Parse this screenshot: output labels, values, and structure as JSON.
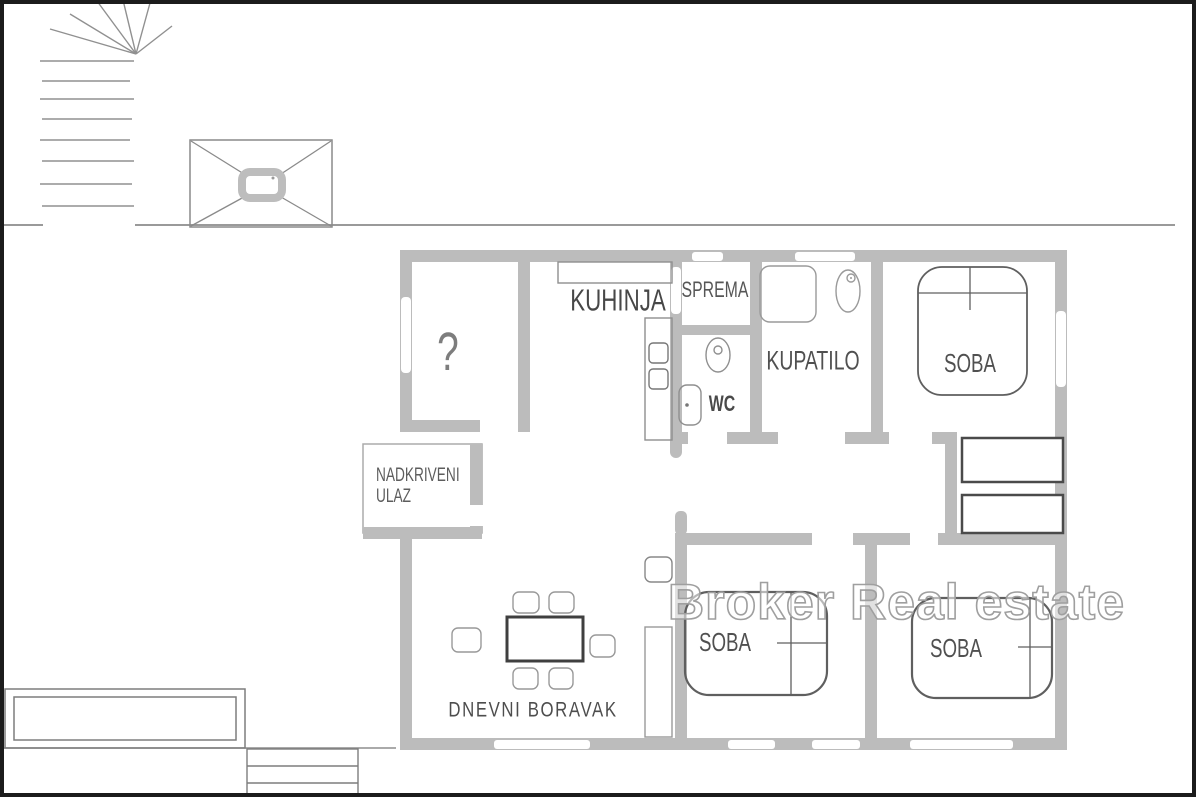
{
  "plan": {
    "labels": {
      "kitchen": "KUHINJA",
      "pantry": "SPREMA",
      "bathroom": "KUPATILO",
      "wc": "WC",
      "bedroom_top": "SOBA",
      "bedroom_middle": "SOBA",
      "bedroom_right": "SOBA",
      "living_room": "DNEVNI BORAVAK",
      "unknown_room": "?",
      "covered_entrance_line1": "NADKRIVENI",
      "covered_entrance_line2": "ULAZ"
    },
    "watermark": "Broker Real estate",
    "colors": {
      "wall": "#bcbcbc",
      "thin_outline": "#8f8f8f",
      "dark_furniture": "#4a4a4a",
      "label_text": "#4d4d4d",
      "watermark_outline": "#9f9f9f",
      "frame": "#1c1c1c",
      "background": "#ffffff"
    }
  }
}
